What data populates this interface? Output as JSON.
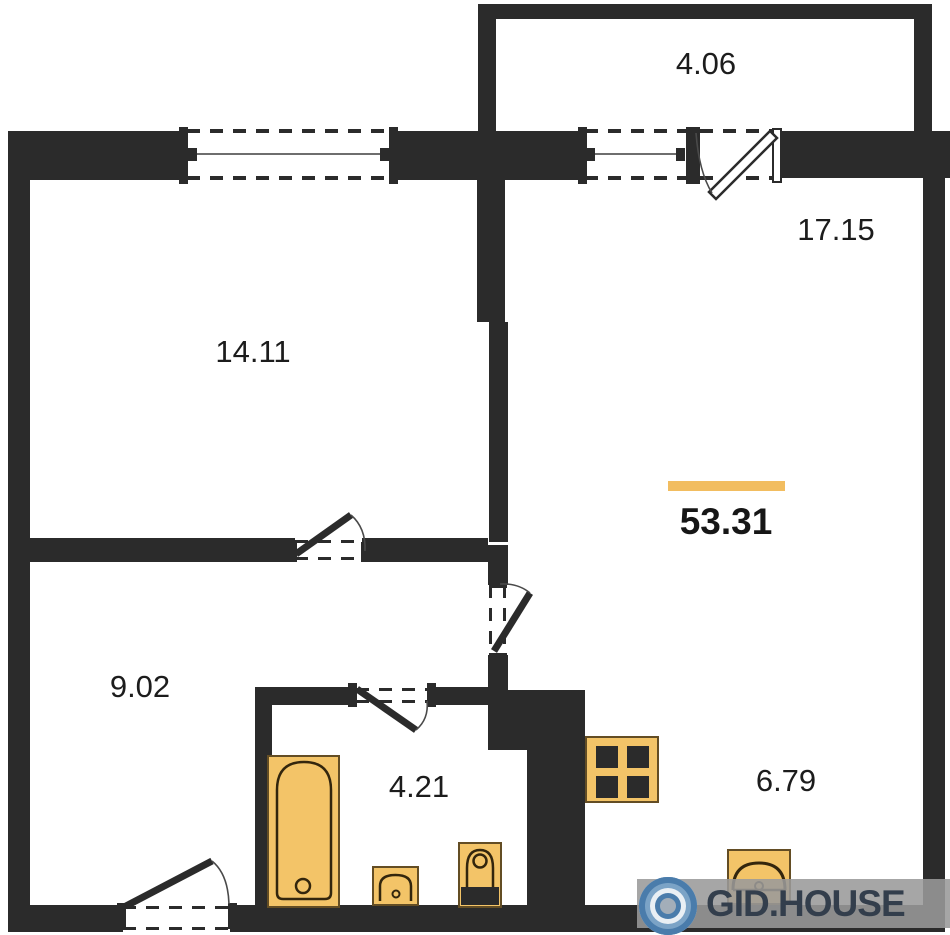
{
  "plan_type": "apartment-floor-plan",
  "rooms": {
    "balcony": {
      "area": "4.06"
    },
    "living_room": {
      "area": "17.15"
    },
    "bedroom": {
      "area": "14.11"
    },
    "hallway": {
      "area": "9.02"
    },
    "bathroom": {
      "area": "4.21"
    },
    "kitchen": {
      "area": "6.79"
    }
  },
  "total": {
    "area": "53.31"
  },
  "watermark": {
    "brand": "GID.HOUSE"
  },
  "icons": [
    "bathtub-icon",
    "sink-icon",
    "toilet-icon",
    "stove-icon",
    "kitchen-sink-icon",
    "window-icon",
    "door-swing-icon",
    "gid-house-logo-icon"
  ],
  "colors": {
    "wall": "#2b2b2b",
    "fixture_fill": "#f3c468",
    "fixture_outline": "#33260d",
    "area_accent_bar": "#f2bd60",
    "watermark_band": "#9a9a9a",
    "watermark_text": "#333e4c",
    "logo_blue": "#4a7cab"
  }
}
